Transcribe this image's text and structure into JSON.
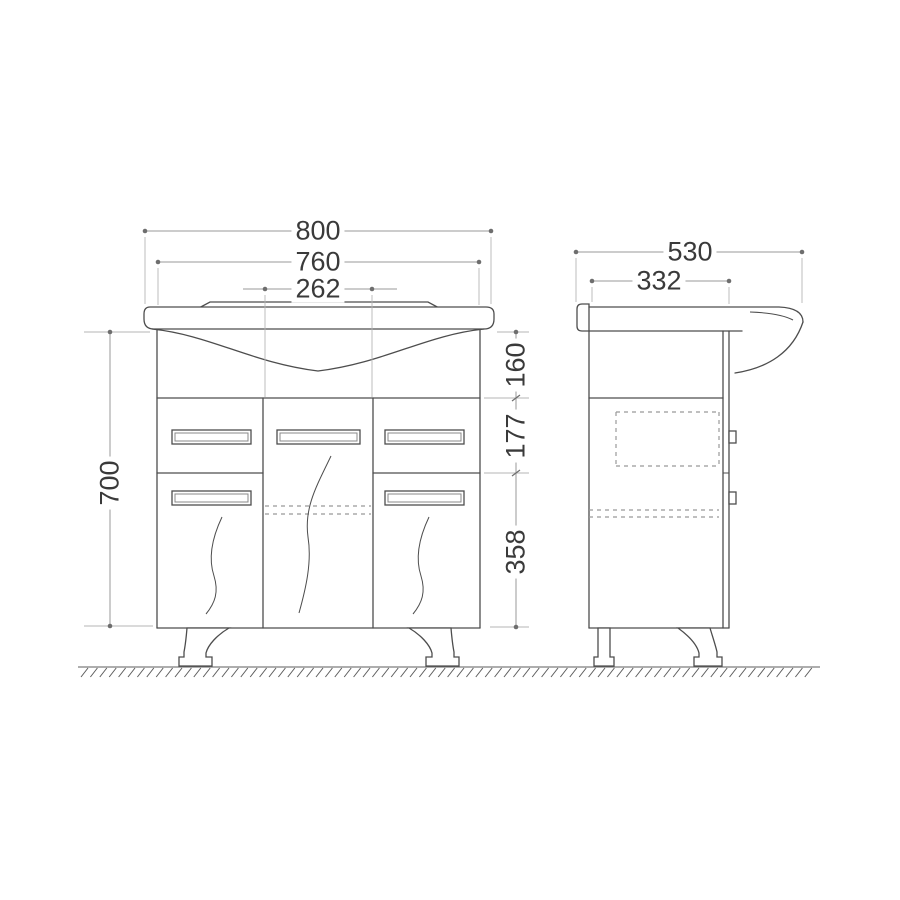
{
  "drawing_type": "vanity-cabinet-dimension-drawing",
  "dims": {
    "front": {
      "overall_width": "800",
      "cabinet_width": "760",
      "center_door_width": "262",
      "cabinet_height": "700",
      "basin_section_height": "160",
      "drawer_section_height": "177",
      "door_section_height": "358"
    },
    "side": {
      "overall_depth": "530",
      "cabinet_depth": "332"
    }
  },
  "colors": {
    "line": "#4d4d4d",
    "dim": "#9a9a9a",
    "text": "#3a3a3a",
    "background": "#ffffff"
  }
}
